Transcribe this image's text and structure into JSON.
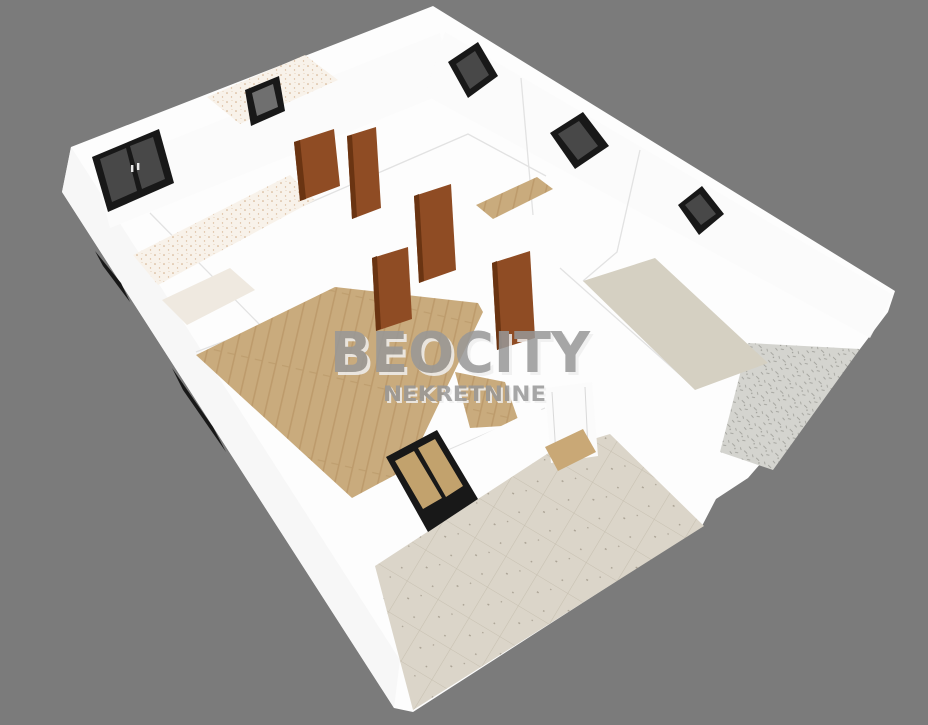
{
  "scene": {
    "type": "3d-floor-plan-render",
    "agency": "BEOCITY NEKRETNINE"
  },
  "watermark": {
    "line1": "BEOCITY",
    "line2": "NEKRETNINE"
  },
  "colors": {
    "background": "#7b7b7b",
    "building": "#fdfdfd",
    "wall_face": "#fbfbfb",
    "wall_face_shade": "#f5f5f5",
    "edge": "#e2e2e2",
    "wood": "#c9ab7d",
    "wood_stripe": "#b28e5e",
    "tile": "#dbd5c9",
    "tile_line": "#c7c0b1",
    "tile_dot": "#aaa294",
    "beige": "#d5d0c2",
    "bath_floor": "#efe9e0",
    "speckle_base": "#f8f2ea",
    "speckle_dot": "#d0ab85",
    "door": "#8f4c24",
    "door_dark": "#6a3412",
    "window_frame": "#181818",
    "window_glass": "#484848",
    "window_glass_small": "#6f6f6f",
    "window_glass_wood": "#c2a26d",
    "exterior_panel": "#d4d4cf",
    "exterior_panel_dot": "#9b9b95",
    "threshold": "#c9a876",
    "entry_door": "#fbfbfb",
    "entry_door_line": "#d9d9d9",
    "watermark_text": "#989898",
    "watermark_shadow": "#f0f0f0"
  }
}
